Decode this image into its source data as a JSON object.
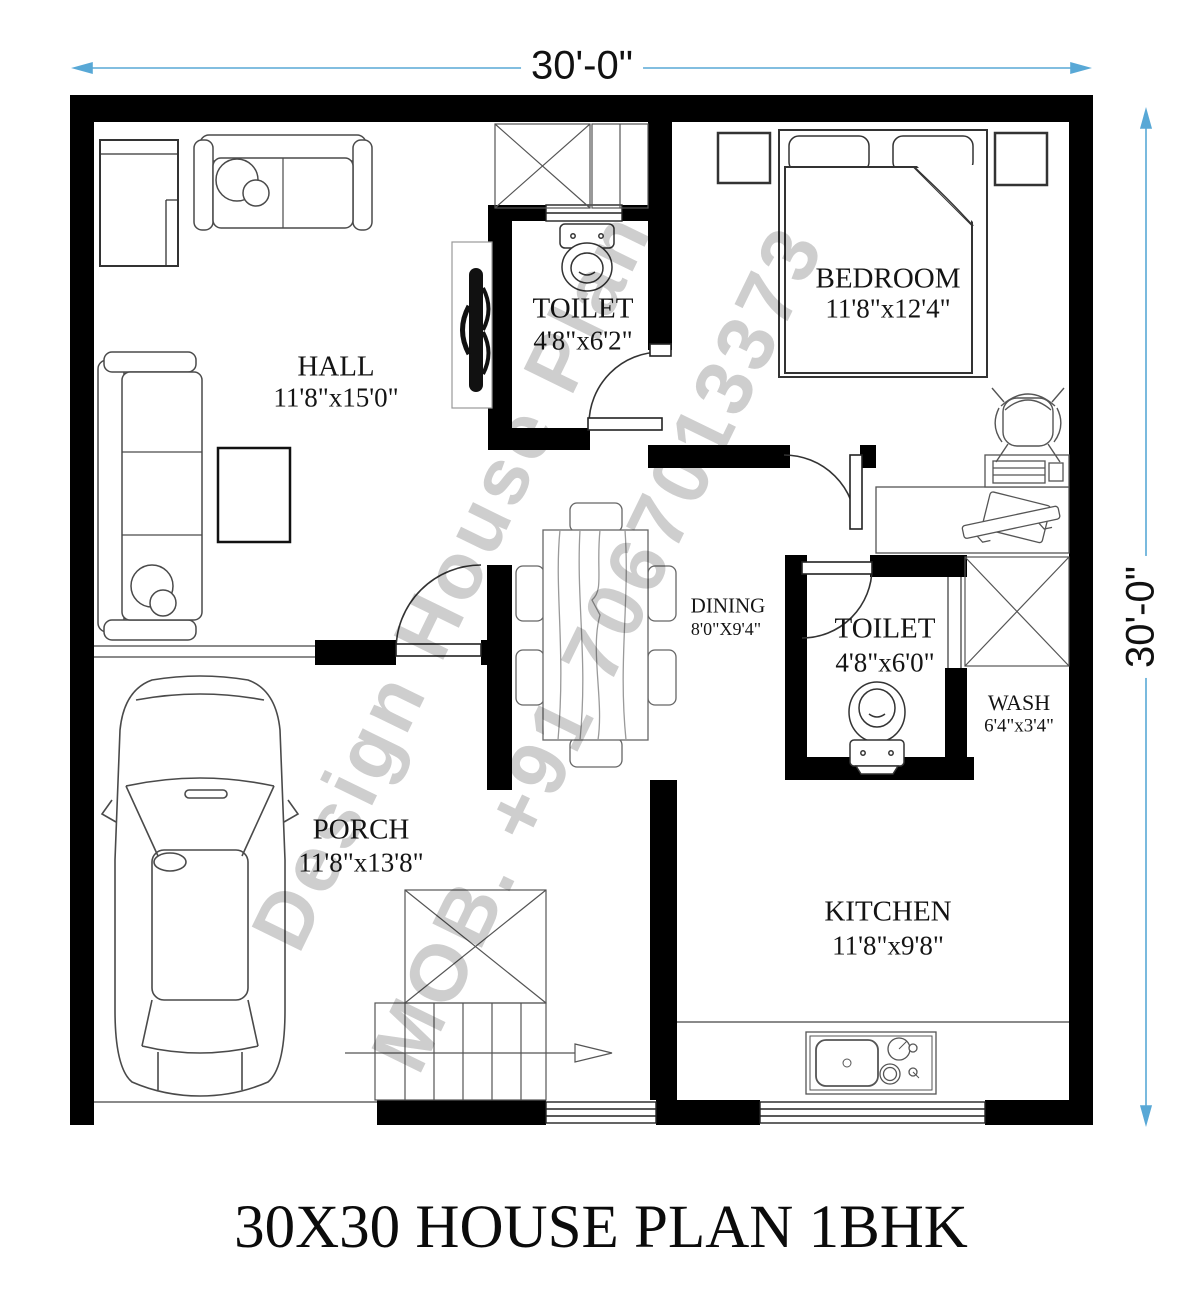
{
  "title": "30X30 HOUSE PLAN 1BHK",
  "dimensions": {
    "top": "30'-0\"",
    "right": "30'-0\""
  },
  "watermark": {
    "line1": "Design House Plan",
    "line2": "MOB. +91 7067013373"
  },
  "rooms": {
    "hall": {
      "name": "HALL",
      "size": "11'8\"x15'0\""
    },
    "toilet_top": {
      "name": "TOILET",
      "size": "4'8\"x6'2\""
    },
    "bedroom": {
      "name": "BEDROOM",
      "size": "11'8\"x12'4\""
    },
    "dining": {
      "name": "DINING",
      "size": "8'0\"X9'4\""
    },
    "toilet_bottom": {
      "name": "TOILET",
      "size": "4'8\"x6'0\""
    },
    "wash": {
      "name": "WASH",
      "size": "6'4\"x3'4\""
    },
    "porch": {
      "name": "PORCH",
      "size": "11'8\"x13'8\""
    },
    "kitchen": {
      "name": "KITCHEN",
      "size": "11'8\"x9'8\""
    }
  },
  "colors": {
    "wall": "#000000",
    "dimension_line": "#58a8d6",
    "furniture_line": "#4a4a4a",
    "watermark": "#c2c2c2"
  }
}
